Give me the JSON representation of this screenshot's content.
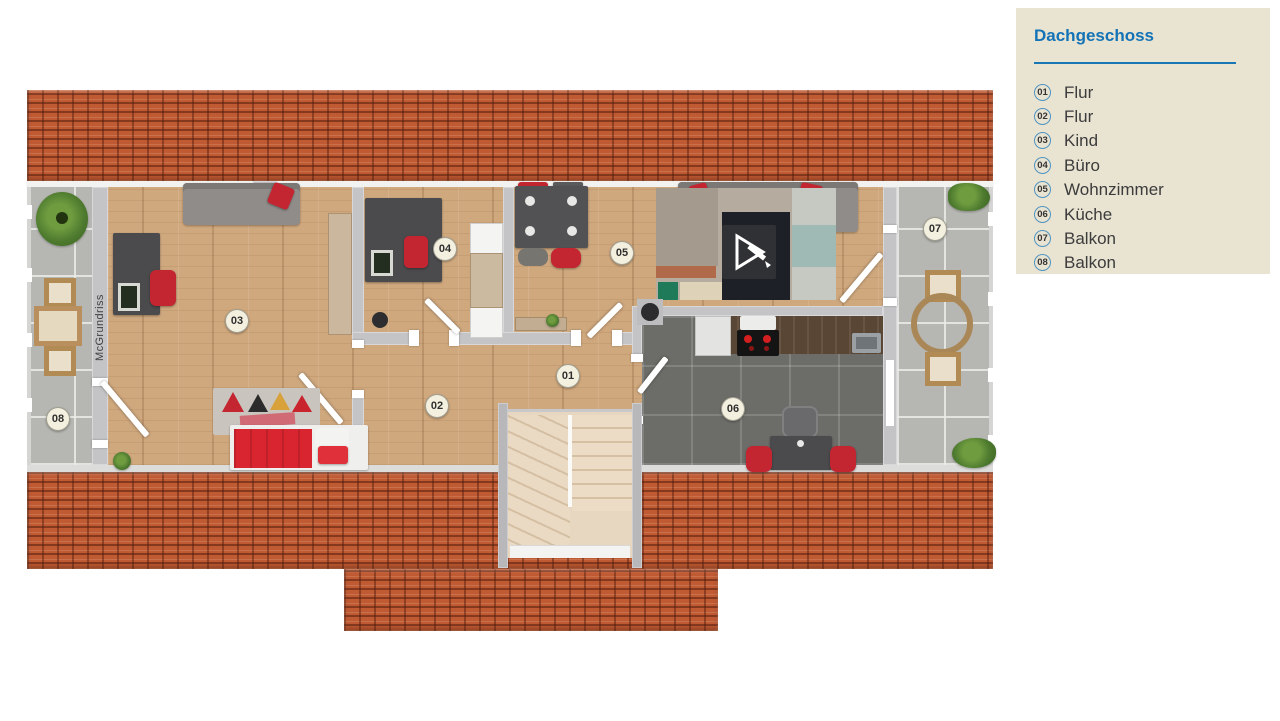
{
  "legend": {
    "title": "Dachgeschoss",
    "items": [
      {
        "num": "01",
        "label": "Flur"
      },
      {
        "num": "02",
        "label": "Flur"
      },
      {
        "num": "03",
        "label": "Kind"
      },
      {
        "num": "04",
        "label": "Büro"
      },
      {
        "num": "05",
        "label": "Wohnzimmer"
      },
      {
        "num": "06",
        "label": "Küche"
      },
      {
        "num": "07",
        "label": "Balkon"
      },
      {
        "num": "08",
        "label": "Balkon"
      }
    ]
  },
  "plan": {
    "floor_name": "Dachgeschoss",
    "watermark": "McGrundriss",
    "badges": [
      {
        "num": "01",
        "x": 568,
        "y": 376
      },
      {
        "num": "02",
        "x": 437,
        "y": 406
      },
      {
        "num": "03",
        "x": 237,
        "y": 321
      },
      {
        "num": "04",
        "x": 445,
        "y": 249
      },
      {
        "num": "05",
        "x": 622,
        "y": 253
      },
      {
        "num": "06",
        "x": 733,
        "y": 409
      },
      {
        "num": "07",
        "x": 935,
        "y": 229
      },
      {
        "num": "08",
        "x": 58,
        "y": 419
      }
    ]
  },
  "colors": {
    "accent_blue": "#1473b6",
    "panel_bg": "#e9e3d2",
    "roof_terracotta": "#bf5a33",
    "wood_floor": "#cfa87e",
    "kitchen_tile": "#6d6d69",
    "balcony_tile": "#b6b6b2",
    "wall_gray": "#c4c4c7",
    "accent_red": "#c32531",
    "text_dark": "#3c3c3c"
  }
}
